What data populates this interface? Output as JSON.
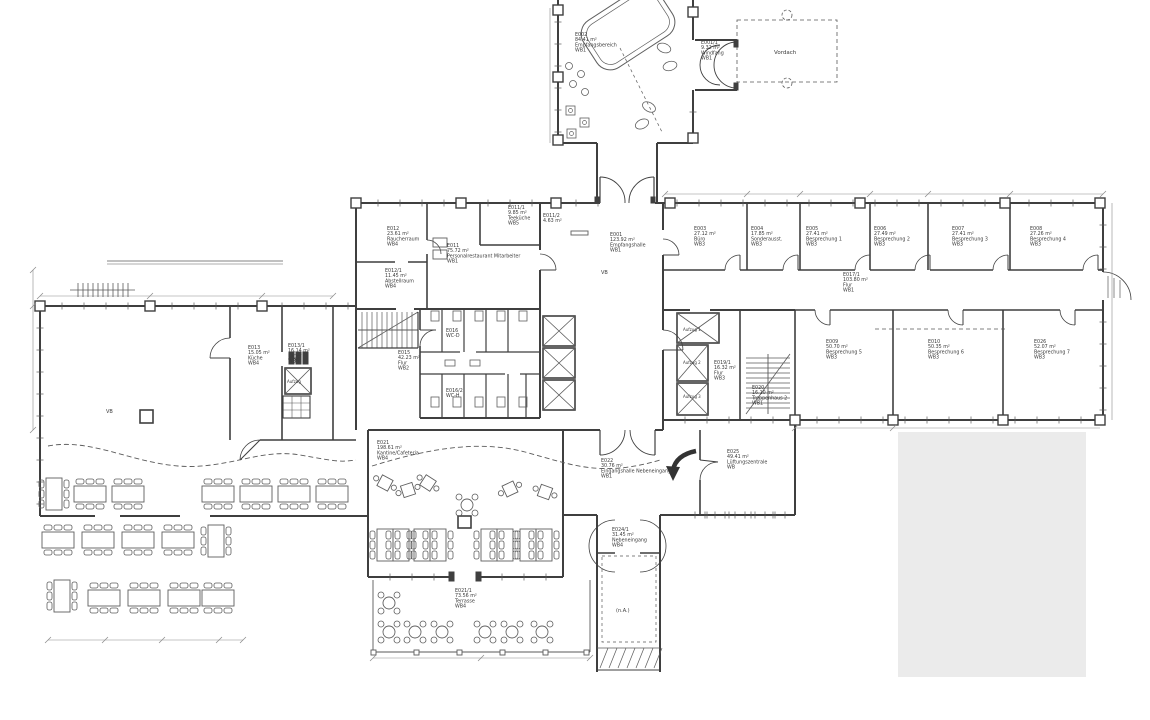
{
  "drawing": {
    "type": "architectural-floor-plan",
    "background": "#ffffff",
    "wall_color": "#3f3f3f",
    "thin_color": "#5a5a5a",
    "furniture_color": "#5f5f5f",
    "dim_color": "#8a8a8a",
    "label_color": "#3c3c3c",
    "masked_area_color": "#ebebeb"
  },
  "rooms": [
    {
      "id": "E002",
      "area": "84.41 m²",
      "name": "Empfangsbereich",
      "wb": "WB1",
      "x": 575,
      "y": 36
    },
    {
      "id": "E001/1",
      "area": "9.32 m²",
      "name": "Windfang",
      "wb": "WB1",
      "x": 701,
      "y": 44
    },
    {
      "id": "E001",
      "area": "123.92 m²",
      "name": "Empfangshalle",
      "wb": "WB1",
      "x": 610,
      "y": 236
    },
    {
      "id": "E011",
      "area": "75.72 m²",
      "name": "Personalrestaurant Mitarbeiter",
      "wb": "WB1",
      "x": 447,
      "y": 247
    },
    {
      "id": "E011/1",
      "area": "9.85 m²",
      "name": "Teeküche",
      "wb": "WB5",
      "x": 508,
      "y": 209
    },
    {
      "id": "E011/2",
      "area": "4.63 m²",
      "name": "",
      "wb": "",
      "x": 543,
      "y": 217
    },
    {
      "id": "E012",
      "area": "23.61 m²",
      "name": "Raucherraum",
      "wb": "WB4",
      "x": 387,
      "y": 230
    },
    {
      "id": "E012/1",
      "area": "11.45 m²",
      "name": "Abstellraum",
      "wb": "WB4",
      "x": 385,
      "y": 272
    },
    {
      "id": "E015",
      "area": "42.23 m²",
      "name": "Flur",
      "wb": "WB2",
      "x": 398,
      "y": 354
    },
    {
      "id": "E016",
      "area": "",
      "name": "WC-D",
      "wb": "",
      "x": 446,
      "y": 332
    },
    {
      "id": "E016/2",
      "area": "",
      "name": "WC-H",
      "wb": "",
      "x": 446,
      "y": 392
    },
    {
      "id": "E013",
      "area": "15.05 m²",
      "name": "Küche",
      "wb": "WB4",
      "x": 248,
      "y": 349
    },
    {
      "id": "E013/1",
      "area": "16.14 m²",
      "name": "Lager",
      "wb": "WB6",
      "x": 288,
      "y": 347
    },
    {
      "id": "E003",
      "area": "27.12 m²",
      "name": "Büro",
      "wb": "WB3",
      "x": 694,
      "y": 230
    },
    {
      "id": "E004",
      "area": "17.85 m²",
      "name": "Sonderausst.",
      "wb": "WB3",
      "x": 751,
      "y": 230
    },
    {
      "id": "E005",
      "area": "27.41 m²",
      "name": "Besprechung 1",
      "wb": "WB3",
      "x": 806,
      "y": 230
    },
    {
      "id": "E006",
      "area": "27.49 m²",
      "name": "Besprechung 2",
      "wb": "WB3",
      "x": 874,
      "y": 230
    },
    {
      "id": "E007",
      "area": "27.41 m²",
      "name": "Besprechung 3",
      "wb": "WB3",
      "x": 952,
      "y": 230
    },
    {
      "id": "E008",
      "area": "27.26 m²",
      "name": "Besprechung 4",
      "wb": "WB3",
      "x": 1030,
      "y": 230
    },
    {
      "id": "E017/1",
      "area": "103.80 m²",
      "name": "Flur",
      "wb": "WB1",
      "x": 843,
      "y": 276
    },
    {
      "id": "E009",
      "area": "50.70 m²",
      "name": "Besprechung 5",
      "wb": "WB3",
      "x": 826,
      "y": 343
    },
    {
      "id": "E010",
      "area": "50.35 m²",
      "name": "Besprechung 6",
      "wb": "WB3",
      "x": 928,
      "y": 343
    },
    {
      "id": "E026",
      "area": "52.07 m²",
      "name": "Besprechung 7",
      "wb": "WB3",
      "x": 1034,
      "y": 343
    },
    {
      "id": "E019/1",
      "area": "16.32 m²",
      "name": "Flur",
      "wb": "WB3",
      "x": 714,
      "y": 364
    },
    {
      "id": "E020",
      "area": "16.10 m²",
      "name": "Treppenhaus 2",
      "wb": "WB1",
      "x": 752,
      "y": 389
    },
    {
      "id": "E021",
      "area": "198.61 m²",
      "name": "Kantine/Cafeteria",
      "wb": "WB4",
      "x": 377,
      "y": 444
    },
    {
      "id": "E022",
      "area": "30.76 m²",
      "name": "Eingangshalle Nebeneingang",
      "wb": "WB1",
      "x": 601,
      "y": 462
    },
    {
      "id": "E025",
      "area": "49.41 m²",
      "name": "Lüftungszentrale",
      "wb": "WB",
      "x": 727,
      "y": 453
    },
    {
      "id": "E024/1",
      "area": "31.45 m²",
      "name": "Nebeneingang",
      "wb": "WB4",
      "x": 612,
      "y": 531
    },
    {
      "id": "E021/1",
      "area": "73.56 m²",
      "name": "Terrasse",
      "wb": "WB4",
      "x": 455,
      "y": 592
    }
  ],
  "annotations": [
    {
      "text": "Vordach",
      "x": 774,
      "y": 54,
      "fs": 5.5
    },
    {
      "text": "VB",
      "x": 601,
      "y": 274,
      "fs": 5
    },
    {
      "text": "VB",
      "x": 106,
      "y": 413,
      "fs": 5
    },
    {
      "text": "Aufzug 1",
      "x": 683,
      "y": 331,
      "fs": 4
    },
    {
      "text": "Aufzug 2",
      "x": 683,
      "y": 364,
      "fs": 4
    },
    {
      "text": "Aufzug 3",
      "x": 683,
      "y": 398,
      "fs": 4
    },
    {
      "text": "Aufzug",
      "x": 287,
      "y": 383,
      "fs": 4
    },
    {
      "text": "(n.A.)",
      "x": 616,
      "y": 612,
      "fs": 5
    }
  ]
}
